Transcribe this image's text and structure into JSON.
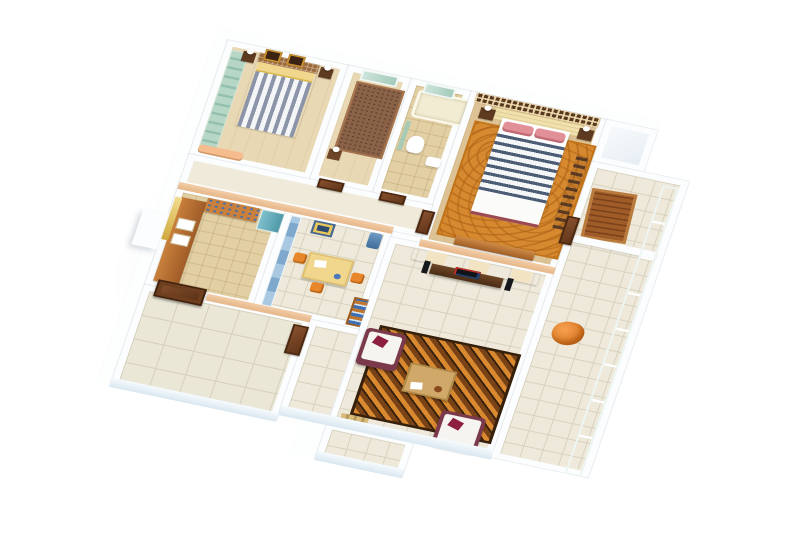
{
  "image_type": "3d-isometric-floor-plan-render",
  "background": "#ffffff",
  "palette": {
    "wall": "#fbfdfe",
    "wallshade": "#e8eef3",
    "floorwood": "#e9d8b4",
    "floorwoodwarm": "#dcc294",
    "tile": "#eee9da",
    "tileline": "#d7d1be",
    "tilewarm": "#e2d0a4",
    "door": "#7c4a28",
    "doordark": "#57300f",
    "teal": "#b7d7c6",
    "tealdark": "#93bfae",
    "orange": "#e8862c",
    "orangedeep": "#c96f1a",
    "maroon": "#7b3a4b",
    "crimson": "#8e1f40",
    "yellow": "#f1d78e",
    "navy": "#4d5d75",
    "pink": "#e29098",
    "cream": "#efe0ae",
    "lattice": "#58391f",
    "rugorange": "#d6892e",
    "rugbrown": "#6e3e15",
    "rugdark": "#34200c",
    "blueglass": "#93b9d8",
    "bluebook": "#3e6fb4",
    "peach": "#f2c89e",
    "chaise": "#f5bd8d",
    "fridge": "#64aebc",
    "parapethi": "#f6fbfe",
    "parapetlo": "#d9e7f0"
  },
  "rooms": [
    {
      "id": "bedroom-2",
      "furniture": [
        "teal-sliding-wardrobe",
        "striped-double-bed",
        "yellow-blanket",
        "two-wall-pictures",
        "nightstands-with-lamps",
        "peach-chaise"
      ]
    },
    {
      "id": "study-bedroom",
      "furniture": [
        "window",
        "brown-daybed",
        "side-table-lamp"
      ]
    },
    {
      "id": "bathroom",
      "furniture": [
        "bathtub",
        "toilet",
        "washbasin",
        "glass-partition",
        "window"
      ]
    },
    {
      "id": "master-bedroom",
      "furniture": [
        "lattice-screen",
        "padded-headboard",
        "navy-striped-bed",
        "pink-pillows",
        "nightstands-with-lamps",
        "orange-rug",
        "dresser",
        "wardrobe-slats"
      ]
    },
    {
      "id": "hallway",
      "furniture": [
        "door-to-study",
        "door-to-bathroom",
        "door-to-master"
      ]
    },
    {
      "id": "kitchen",
      "furniture": [
        "counter-with-sinks",
        "crockery-shelf",
        "refrigerator",
        "window-curtain"
      ]
    },
    {
      "id": "dining-room",
      "furniture": [
        "blue-glass-partition",
        "yellow-dining-table",
        "orange-chairs",
        "wall-picture",
        "water-cooler",
        "bookshelf"
      ]
    },
    {
      "id": "entry-hall",
      "furniture": [
        "main-double-door",
        "side-door",
        "floor-tiles"
      ]
    },
    {
      "id": "living-room",
      "furniture": [
        "tv-feature-wall",
        "tv-console",
        "television",
        "speakers",
        "two-sofas",
        "coffee-table",
        "swirl-rug",
        "shoe-mat"
      ]
    },
    {
      "id": "balcony-east",
      "furniture": [
        "glass-railing",
        "wood-deck-mat",
        "orange-lounge-chair",
        "balcony-door"
      ]
    },
    {
      "id": "balcony-south",
      "furniture": []
    }
  ]
}
